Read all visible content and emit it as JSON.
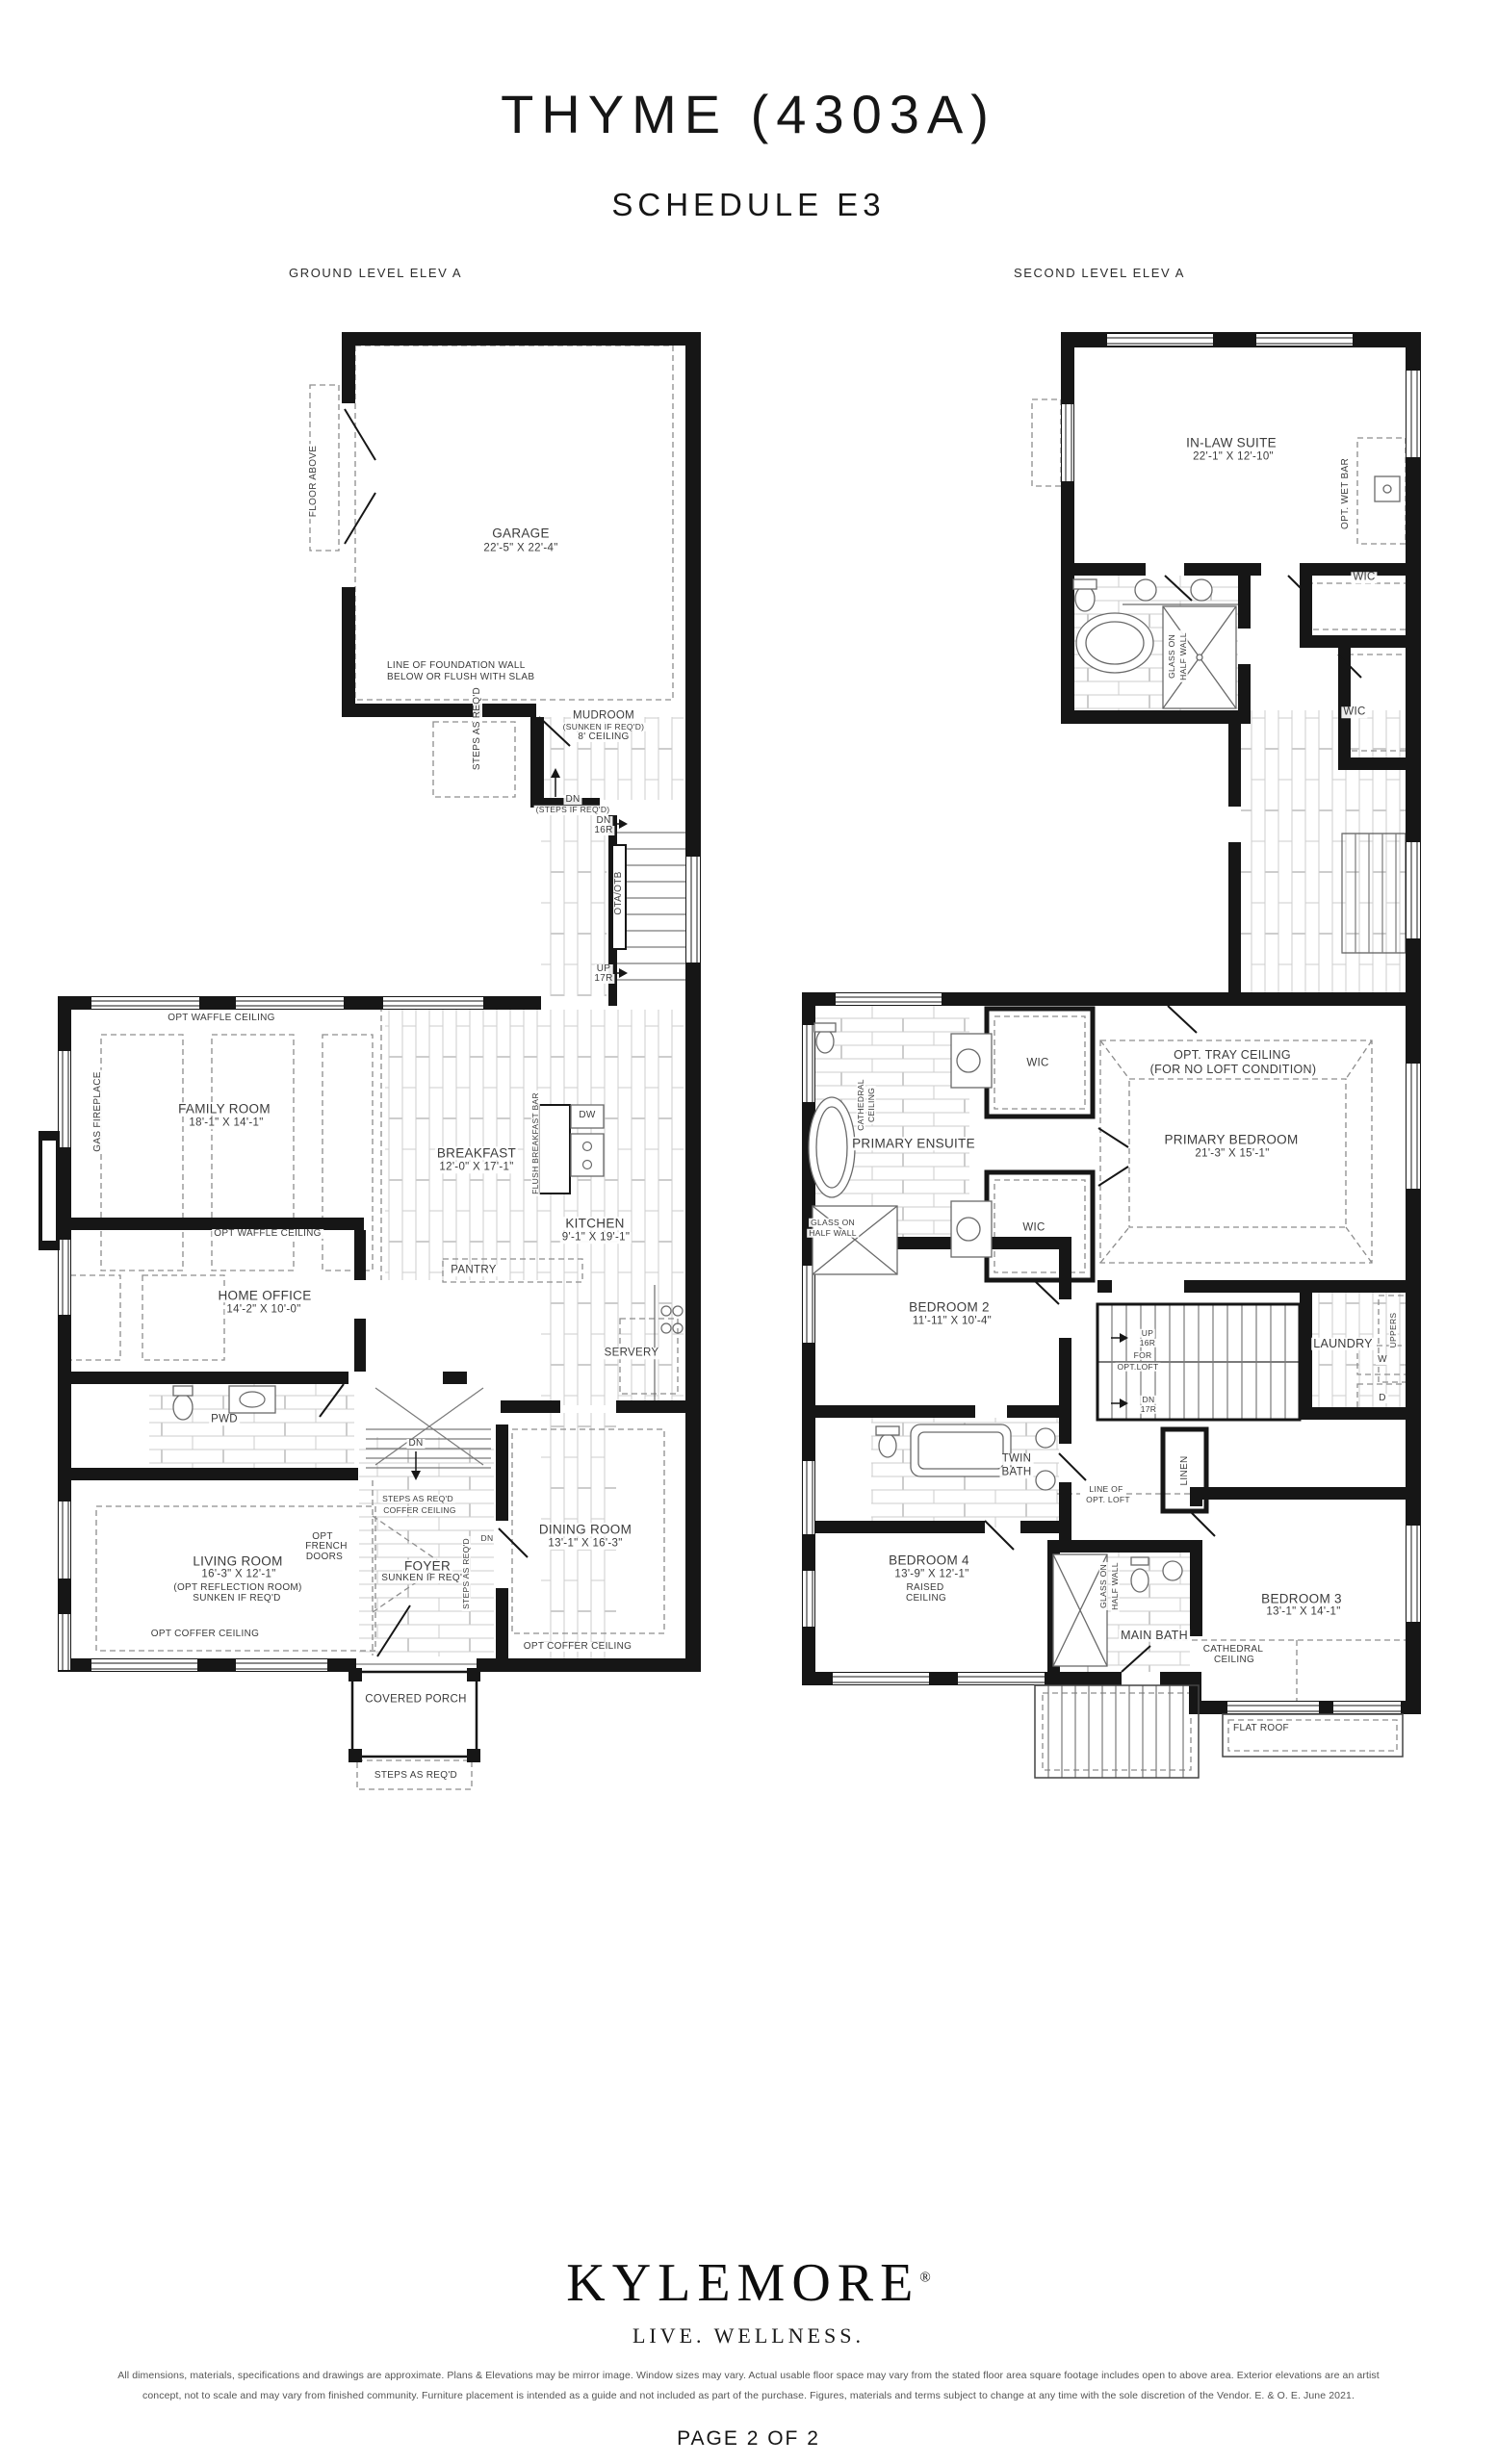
{
  "header": {
    "title": "THYME (4303A)",
    "subtitle": "SCHEDULE E3",
    "ground_plan_label": "GROUND LEVEL ELEV A",
    "second_plan_label": "SECOND LEVEL ELEV A"
  },
  "ground": {
    "floor_above": "FLOOR ABOVE",
    "garage_name": "GARAGE",
    "garage_dims": "22'-5\" X 22'-4\"",
    "foundation1": "LINE OF FOUNDATION WALL",
    "foundation2": "BELOW OR FLUSH WITH SLAB",
    "steps_garage": "STEPS AS REQ'D",
    "mudroom_name": "MUDROOM",
    "mudroom_note1": "(SUNKEN IF REQ'D)",
    "mudroom_note2": "8' CEILING",
    "dn": "DN",
    "dn_steps_note": "(STEPS IF REQ'D)",
    "stair_dn1": "DN",
    "stair_dn2": "16R",
    "stair_code": "OTA/OTB",
    "stair_up1": "UP",
    "stair_up2": "17R",
    "family_ceiling": "OPT WAFFLE CEILING",
    "family_name": "FAMILY ROOM",
    "family_dims": "18'-1\" X 14'-1\"",
    "fireplace": "GAS FIREPLACE",
    "breakfast_name": "BREAKFAST",
    "breakfast_dims": "12'-0\" X 17'-1\"",
    "breakfast_bar": "FLUSH BREAKFAST BAR",
    "dw": "DW",
    "kitchen_name": "KITCHEN",
    "kitchen_dims": "9'-1\" X 19'-1\"",
    "office_ceiling": "OPT WAFFLE CEILING",
    "office_name": "HOME OFFICE",
    "office_dims": "14'-2\" X 10'-0\"",
    "pantry": "PANTRY",
    "servery": "SERVERY",
    "pwd": "PWD",
    "living_name": "LIVING ROOM",
    "living_dims": "16'-3\" X 12'-1\"",
    "living_note1": "(OPT REFLECTION ROOM)",
    "living_note2": "SUNKEN IF REQ'D",
    "living_ceiling": "OPT COFFER CEILING",
    "french1": "OPT",
    "french2": "FRENCH",
    "french3": "DOORS",
    "foyer_dn": "DN",
    "foyer_steps1": "STEPS AS REQ'D",
    "foyer_steps2": "COFFER CEILING",
    "foyer_name": "FOYER",
    "foyer_note": "SUNKEN IF REQ'D",
    "hall_dn": "DN",
    "foyer_steps_side": "STEPS AS REQ'D",
    "dining_name": "DINING ROOM",
    "dining_dims": "13'-1\" X 16'-3\"",
    "dining_ceiling": "OPT COFFER CEILING",
    "porch_name": "COVERED PORCH",
    "porch_steps": "STEPS AS REQ'D"
  },
  "second": {
    "inlaw_name": "IN-LAW SUITE",
    "inlaw_dims": "22'-1\" X 12'-10\"",
    "wet_bar": "OPT. WET BAR",
    "wic1": "WIC",
    "wic2": "WIC",
    "glass1a": "GLASS ON",
    "glass1b": "HALF WALL",
    "ensuite": "PRIMARY ENSUITE",
    "cath1a": "CATHEDRAL",
    "cath1b": "CEILING",
    "glass2a": "GLASS ON",
    "glass2b": "HALF WALL",
    "wic3": "WIC",
    "wic4": "WIC",
    "tray1": "OPT. TRAY CEILING",
    "tray2": "(FOR NO LOFT CONDITION)",
    "primary_name": "PRIMARY BEDROOM",
    "primary_dims": "21'-3\" X 15'-1\"",
    "bed2_name": "BEDROOM 2",
    "bed2_dims": "11'-11\" X 10'-4\"",
    "up1": "UP",
    "up2": "16R",
    "up3": "FOR",
    "up4": "OPT.LOFT",
    "dn1": "DN",
    "dn2": "17R",
    "laundry": "LAUNDRY",
    "uppers": "UPPERS",
    "washer": "W",
    "dryer": "D",
    "twin1": "TWIN",
    "twin2": "BATH",
    "loft1": "LINE OF",
    "loft2": "OPT. LOFT",
    "linen": "LINEN",
    "bed4_name": "BEDROOM 4",
    "bed4_dims": "13'-9\" X 12'-1\"",
    "bed4_note1": "RAISED",
    "bed4_note2": "CEILING",
    "glass3a": "GLASS ON",
    "glass3b": "HALF WALL",
    "main_bath": "MAIN BATH",
    "bed3_name": "BEDROOM 3",
    "bed3_dims": "13'-1\" X 14'-1\"",
    "cath2a": "CATHEDRAL",
    "cath2b": "CEILING",
    "flat_roof": "FLAT ROOF"
  },
  "footer": {
    "brand": "KYLEMORE",
    "reg": "®",
    "tagline": "LIVE. WELLNESS.",
    "disclaimer1": "All dimensions, materials, specifications and drawings are approximate. Plans & Elevations may be mirror image. Window sizes may vary. Actual usable floor space may vary from the stated floor area square footage includes open to above area. Exterior elevations are an artist",
    "disclaimer2": "concept, not to scale and may vary from finished community. Furniture placement is intended as a guide and not included as part of the purchase. Figures, materials and terms subject to change at any time with the sole discretion of the Vendor.  E. & O. E. June 2021.",
    "page": "PAGE 2 OF 2"
  }
}
